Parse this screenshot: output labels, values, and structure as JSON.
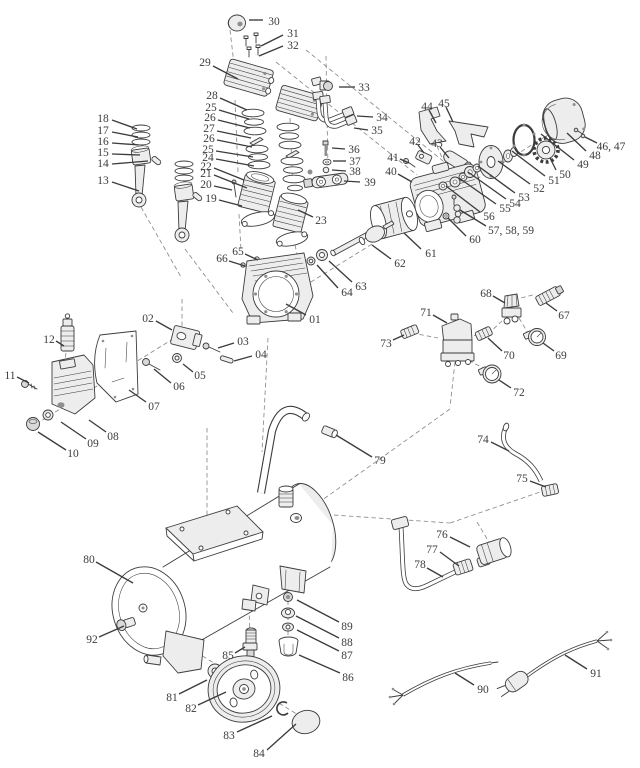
{
  "diagram": {
    "type": "exploded-parts-diagram",
    "subject": "air-compressor",
    "canvas": {
      "width": 640,
      "height": 768
    },
    "colors": {
      "ink": "#3c3c3c",
      "paper": "#ffffff",
      "leader": "#3c3c3c",
      "construction": "#8a8a8a"
    },
    "labels": [
      {
        "n": "30",
        "t": [
          274,
          21
        ],
        "l": [
          263,
          20,
          249,
          20
        ]
      },
      {
        "n": "31",
        "t": [
          293,
          33
        ],
        "l": [
          283,
          35,
          261,
          46
        ]
      },
      {
        "n": "32",
        "t": [
          293,
          45
        ],
        "l": [
          283,
          46,
          259,
          56
        ]
      },
      {
        "n": "29",
        "t": [
          205,
          62
        ],
        "l": [
          213,
          66,
          238,
          79
        ]
      },
      {
        "n": "28",
        "t": [
          212,
          95
        ],
        "l": [
          220,
          98,
          247,
          110
        ]
      },
      {
        "n": "25",
        "t": [
          211,
          107
        ],
        "l": [
          219,
          110,
          249,
          119
        ]
      },
      {
        "n": "26",
        "t": [
          210,
          117
        ],
        "l": [
          218,
          120,
          250,
          128
        ]
      },
      {
        "n": "27",
        "t": [
          209,
          128
        ],
        "l": [
          217,
          131,
          251,
          138
        ]
      },
      {
        "n": "26",
        "t": [
          209,
          138
        ],
        "l": [
          217,
          140,
          252,
          147
        ]
      },
      {
        "n": "25",
        "t": [
          208,
          149
        ],
        "l": [
          216,
          151,
          253,
          157
        ]
      },
      {
        "n": "24",
        "t": [
          208,
          157
        ],
        "l": [
          216,
          159,
          254,
          166
        ]
      },
      {
        "n": "22",
        "t": [
          206,
          166
        ],
        "l": [
          214,
          168,
          244,
          180
        ]
      },
      {
        "n": "21",
        "t": [
          206,
          173
        ],
        "l": [
          214,
          175,
          247,
          188
        ]
      },
      {
        "n": "20",
        "t": [
          206,
          184
        ],
        "l": [
          214,
          186,
          232,
          190
        ]
      },
      {
        "n": "19",
        "t": [
          211,
          198
        ],
        "l": [
          219,
          200,
          242,
          206
        ]
      },
      {
        "n": "18",
        "t": [
          103,
          118
        ],
        "l": [
          112,
          120,
          137,
          129
        ]
      },
      {
        "n": "17",
        "t": [
          103,
          130
        ],
        "l": [
          112,
          132,
          138,
          137
        ]
      },
      {
        "n": "16",
        "t": [
          103,
          141
        ],
        "l": [
          112,
          143,
          139,
          145
        ]
      },
      {
        "n": "15",
        "t": [
          103,
          152
        ],
        "l": [
          112,
          154,
          140,
          155
        ]
      },
      {
        "n": "14",
        "t": [
          103,
          163
        ],
        "l": [
          112,
          164,
          148,
          161
        ]
      },
      {
        "n": "13",
        "t": [
          103,
          180
        ],
        "l": [
          112,
          182,
          139,
          191
        ]
      },
      {
        "n": "33",
        "t": [
          364,
          87
        ],
        "l": [
          355,
          87,
          339,
          87
        ]
      },
      {
        "n": "34",
        "t": [
          382,
          117
        ],
        "l": [
          373,
          117,
          357,
          116
        ]
      },
      {
        "n": "35",
        "t": [
          377,
          130
        ],
        "l": [
          368,
          130,
          354,
          128
        ]
      },
      {
        "n": "36",
        "t": [
          354,
          149
        ],
        "l": [
          345,
          149,
          332,
          148
        ]
      },
      {
        "n": "37",
        "t": [
          355,
          161
        ],
        "l": [
          346,
          161,
          333,
          161
        ]
      },
      {
        "n": "38",
        "t": [
          355,
          171
        ],
        "l": [
          346,
          171,
          332,
          170
        ]
      },
      {
        "n": "39",
        "t": [
          370,
          182
        ],
        "l": [
          360,
          182,
          344,
          181
        ]
      },
      {
        "n": "44",
        "t": [
          427,
          106
        ],
        "l": [
          429,
          110,
          436,
          123
        ]
      },
      {
        "n": "45",
        "t": [
          444,
          103
        ],
        "l": [
          446,
          107,
          453,
          122
        ]
      },
      {
        "n": "42",
        "t": [
          415,
          141
        ],
        "l": [
          418,
          145,
          424,
          153
        ]
      },
      {
        "n": "43",
        "t": [
          437,
          143
        ],
        "l": [
          440,
          147,
          449,
          158
        ]
      },
      {
        "n": "41",
        "t": [
          393,
          157
        ],
        "l": [
          400,
          159,
          409,
          163
        ]
      },
      {
        "n": "40",
        "t": [
          391,
          171
        ],
        "l": [
          398,
          174,
          412,
          182
        ]
      },
      {
        "n": "46, 47",
        "t": [
          611,
          146
        ],
        "l": [
          597,
          143,
          585,
          137
        ]
      },
      {
        "n": "48",
        "t": [
          595,
          155
        ],
        "l": [
          586,
          151,
          567,
          133
        ]
      },
      {
        "n": "49",
        "t": [
          583,
          164
        ],
        "l": [
          574,
          160,
          541,
          134
        ]
      },
      {
        "n": "50",
        "t": [
          565,
          174
        ],
        "l": [
          556,
          170,
          550,
          158
        ]
      },
      {
        "n": "51",
        "t": [
          554,
          180
        ],
        "l": [
          545,
          176,
          512,
          151
        ]
      },
      {
        "n": "52",
        "t": [
          539,
          188
        ],
        "l": [
          530,
          184,
          498,
          161
        ]
      },
      {
        "n": "53",
        "t": [
          524,
          197
        ],
        "l": [
          515,
          193,
          478,
          166
        ]
      },
      {
        "n": "54",
        "t": [
          515,
          203
        ],
        "l": [
          506,
          199,
          468,
          172
        ]
      },
      {
        "n": "55",
        "t": [
          505,
          208
        ],
        "l": [
          496,
          204,
          459,
          178
        ]
      },
      {
        "n": "56",
        "t": [
          489,
          216
        ],
        "l": [
          480,
          212,
          446,
          186
        ]
      },
      {
        "n": "57, 58, 59",
        "t": [
          511,
          230
        ],
        "l": [
          486,
          226,
          460,
          210
        ]
      },
      {
        "n": "60",
        "t": [
          475,
          239
        ],
        "l": [
          466,
          236,
          448,
          218
        ]
      },
      {
        "n": "61",
        "t": [
          431,
          253
        ],
        "l": [
          421,
          249,
          404,
          233
        ]
      },
      {
        "n": "62",
        "t": [
          400,
          263
        ],
        "l": [
          391,
          259,
          372,
          245
        ]
      },
      {
        "n": "63",
        "t": [
          361,
          286
        ],
        "l": [
          352,
          282,
          329,
          261
        ]
      },
      {
        "n": "64",
        "t": [
          347,
          292
        ],
        "l": [
          338,
          288,
          317,
          265
        ]
      },
      {
        "n": "65",
        "t": [
          238,
          251
        ],
        "l": [
          245,
          254,
          258,
          260
        ]
      },
      {
        "n": "66",
        "t": [
          222,
          258
        ],
        "l": [
          229,
          261,
          245,
          266
        ]
      },
      {
        "n": "01",
        "t": [
          315,
          319
        ],
        "l": [
          306,
          315,
          286,
          304
        ]
      },
      {
        "n": "02",
        "t": [
          148,
          318
        ],
        "l": [
          156,
          321,
          172,
          330
        ]
      },
      {
        "n": "03",
        "t": [
          243,
          341
        ],
        "l": [
          234,
          343,
          218,
          348
        ]
      },
      {
        "n": "04",
        "t": [
          261,
          354
        ],
        "l": [
          252,
          356,
          234,
          361
        ]
      },
      {
        "n": "05",
        "t": [
          200,
          375
        ],
        "l": [
          193,
          372,
          183,
          364
        ]
      },
      {
        "n": "06",
        "t": [
          179,
          386
        ],
        "l": [
          171,
          383,
          154,
          369
        ]
      },
      {
        "n": "07",
        "t": [
          154,
          406
        ],
        "l": [
          146,
          402,
          129,
          390
        ]
      },
      {
        "n": "08",
        "t": [
          113,
          436
        ],
        "l": [
          106,
          432,
          89,
          420
        ]
      },
      {
        "n": "09",
        "t": [
          93,
          443
        ],
        "l": [
          86,
          439,
          61,
          422
        ]
      },
      {
        "n": "10",
        "t": [
          73,
          453
        ],
        "l": [
          66,
          450,
          38,
          432
        ]
      },
      {
        "n": "11",
        "t": [
          10,
          375
        ],
        "l": [
          17,
          377,
          29,
          383
        ]
      },
      {
        "n": "12",
        "t": [
          49,
          339
        ],
        "l": [
          56,
          341,
          64,
          346
        ]
      },
      {
        "n": "23",
        "t": [
          321,
          220
        ],
        "l": [
          313,
          217,
          298,
          210
        ]
      },
      {
        "n": "68",
        "t": [
          486,
          293
        ],
        "l": [
          493,
          296,
          505,
          303
        ]
      },
      {
        "n": "67",
        "t": [
          564,
          315
        ],
        "l": [
          557,
          311,
          546,
          303
        ]
      },
      {
        "n": "71",
        "t": [
          426,
          312
        ],
        "l": [
          433,
          315,
          447,
          323
        ]
      },
      {
        "n": "70",
        "t": [
          509,
          355
        ],
        "l": [
          502,
          351,
          488,
          338
        ]
      },
      {
        "n": "69",
        "t": [
          561,
          355
        ],
        "l": [
          554,
          351,
          543,
          343
        ]
      },
      {
        "n": "72",
        "t": [
          519,
          392
        ],
        "l": [
          511,
          388,
          499,
          380
        ]
      },
      {
        "n": "73",
        "t": [
          386,
          343
        ],
        "l": [
          393,
          340,
          404,
          335
        ]
      },
      {
        "n": "79",
        "t": [
          380,
          460
        ],
        "l": [
          372,
          457,
          336,
          435
        ]
      },
      {
        "n": "74",
        "t": [
          483,
          439
        ],
        "l": [
          491,
          442,
          509,
          451
        ]
      },
      {
        "n": "75",
        "t": [
          522,
          478
        ],
        "l": [
          530,
          481,
          546,
          487
        ]
      },
      {
        "n": "76",
        "t": [
          442,
          534
        ],
        "l": [
          450,
          537,
          470,
          547
        ]
      },
      {
        "n": "77",
        "t": [
          432,
          549
        ],
        "l": [
          440,
          552,
          459,
          566
        ]
      },
      {
        "n": "78",
        "t": [
          420,
          564
        ],
        "l": [
          427,
          568,
          443,
          577
        ]
      },
      {
        "n": "80",
        "t": [
          89,
          559
        ],
        "l": [
          96,
          562,
          133,
          583
        ]
      },
      {
        "n": "92",
        "t": [
          92,
          639
        ],
        "l": [
          99,
          637,
          124,
          626
        ]
      },
      {
        "n": "85",
        "t": [
          228,
          655
        ],
        "l": [
          235,
          653,
          245,
          647
        ]
      },
      {
        "n": "81",
        "t": [
          172,
          697
        ],
        "l": [
          179,
          694,
          207,
          680
        ]
      },
      {
        "n": "82",
        "t": [
          191,
          708
        ],
        "l": [
          198,
          705,
          226,
          692
        ]
      },
      {
        "n": "83",
        "t": [
          229,
          735
        ],
        "l": [
          237,
          732,
          272,
          716
        ]
      },
      {
        "n": "84",
        "t": [
          259,
          753
        ],
        "l": [
          267,
          750,
          296,
          724
        ]
      },
      {
        "n": "86",
        "t": [
          348,
          677
        ],
        "l": [
          340,
          673,
          299,
          655
        ]
      },
      {
        "n": "87",
        "t": [
          347,
          655
        ],
        "l": [
          339,
          651,
          297,
          630
        ]
      },
      {
        "n": "88",
        "t": [
          347,
          642
        ],
        "l": [
          339,
          638,
          296,
          616
        ]
      },
      {
        "n": "89",
        "t": [
          347,
          626
        ],
        "l": [
          339,
          622,
          297,
          600
        ]
      },
      {
        "n": "90",
        "t": [
          483,
          689
        ],
        "l": [
          474,
          685,
          455,
          673
        ]
      },
      {
        "n": "91",
        "t": [
          596,
          673
        ],
        "l": [
          587,
          669,
          565,
          655
        ]
      }
    ]
  }
}
